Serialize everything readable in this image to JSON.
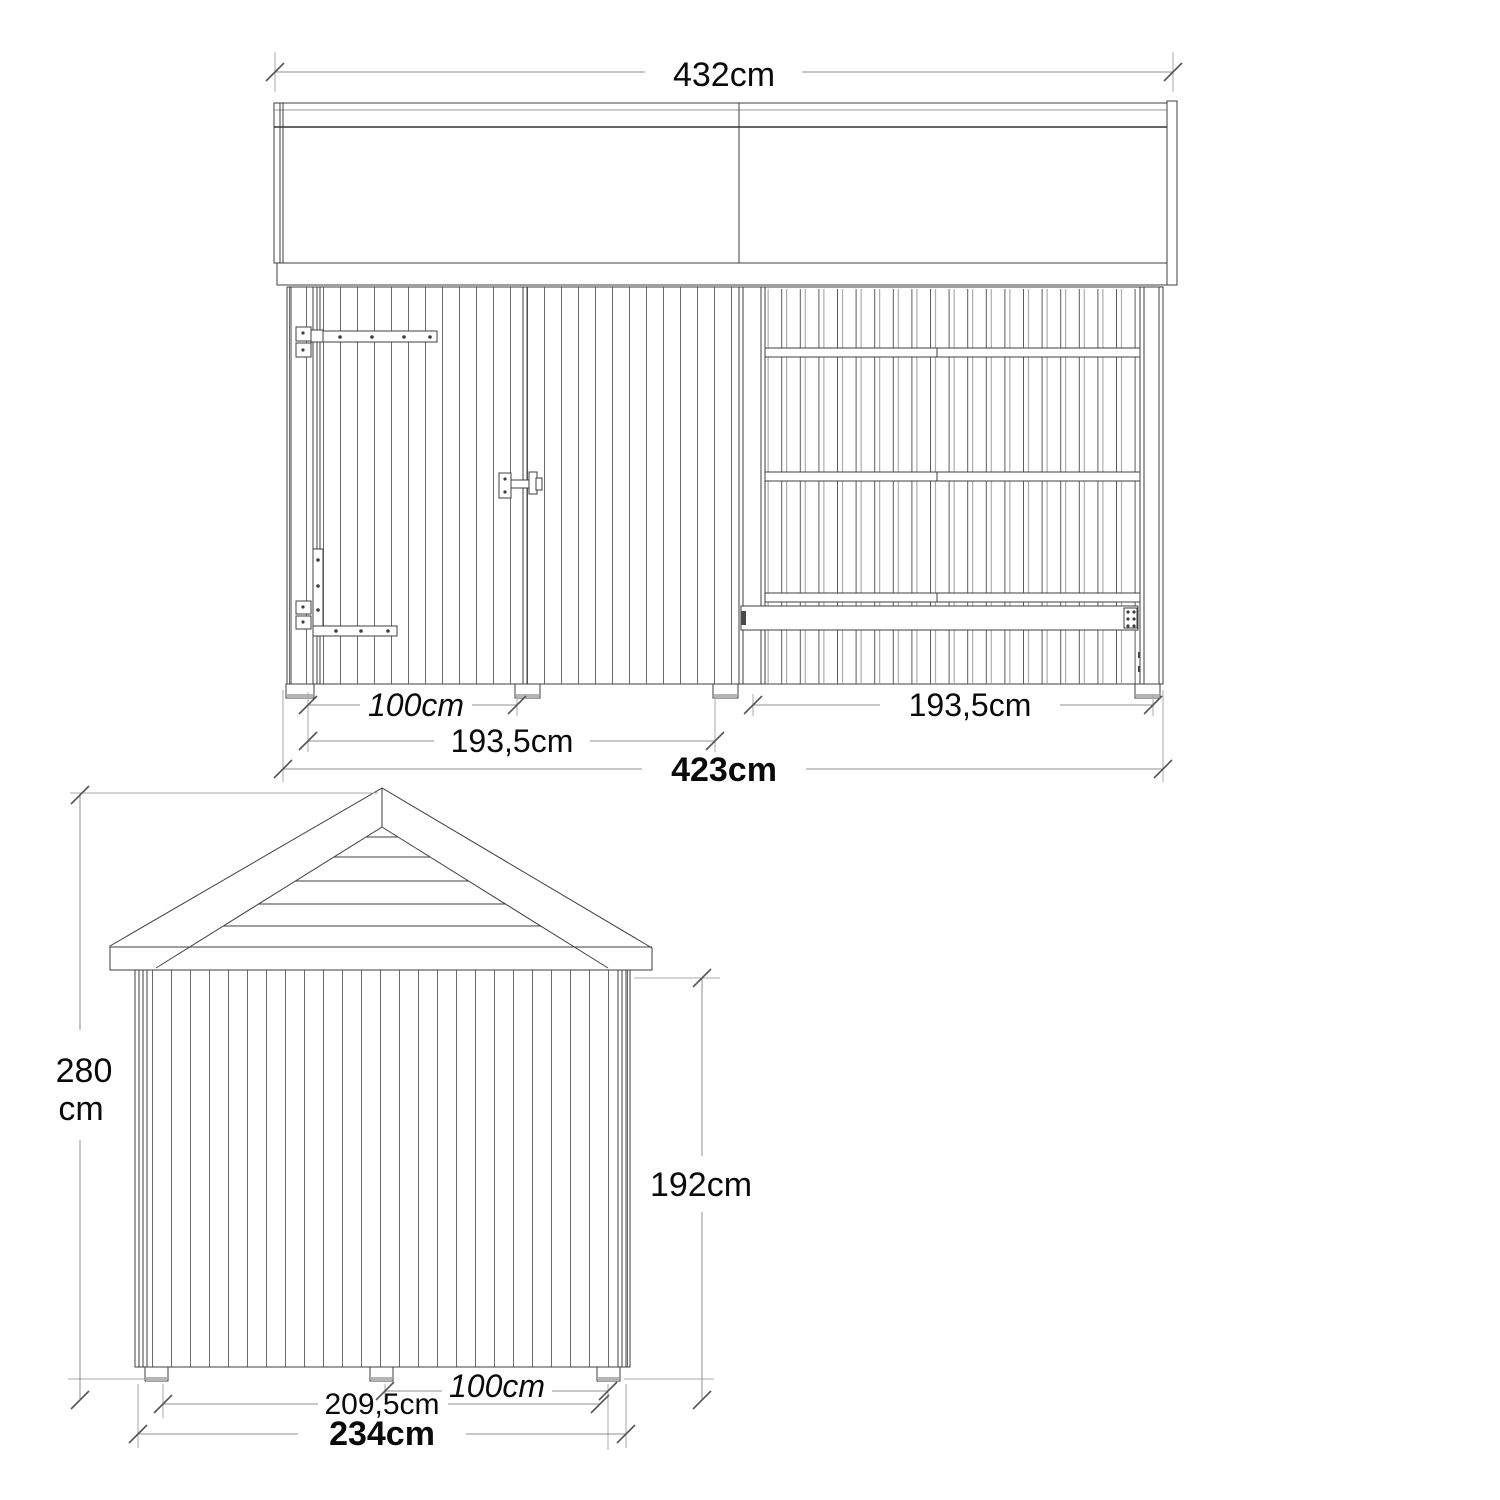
{
  "meta": {
    "background_color": "#ffffff",
    "drawing_line_color": "#3f3f3f",
    "dimension_line_color": "#8f8f8f",
    "text_color": "#0a0a0a"
  },
  "front_elevation": {
    "dim_roof_total_width": "432cm",
    "dim_door_width": "100cm",
    "dim_left_bay_width": "193,5cm",
    "dim_right_bay_width": "193,5cm",
    "dim_total_width": "423cm"
  },
  "side_elevation": {
    "dim_total_height_value": "280",
    "dim_total_height_unit": "cm",
    "dim_wall_height": "192cm",
    "dim_inner_width": "209,5cm",
    "dim_bay_depth": "100cm",
    "dim_total_depth": "234cm"
  }
}
